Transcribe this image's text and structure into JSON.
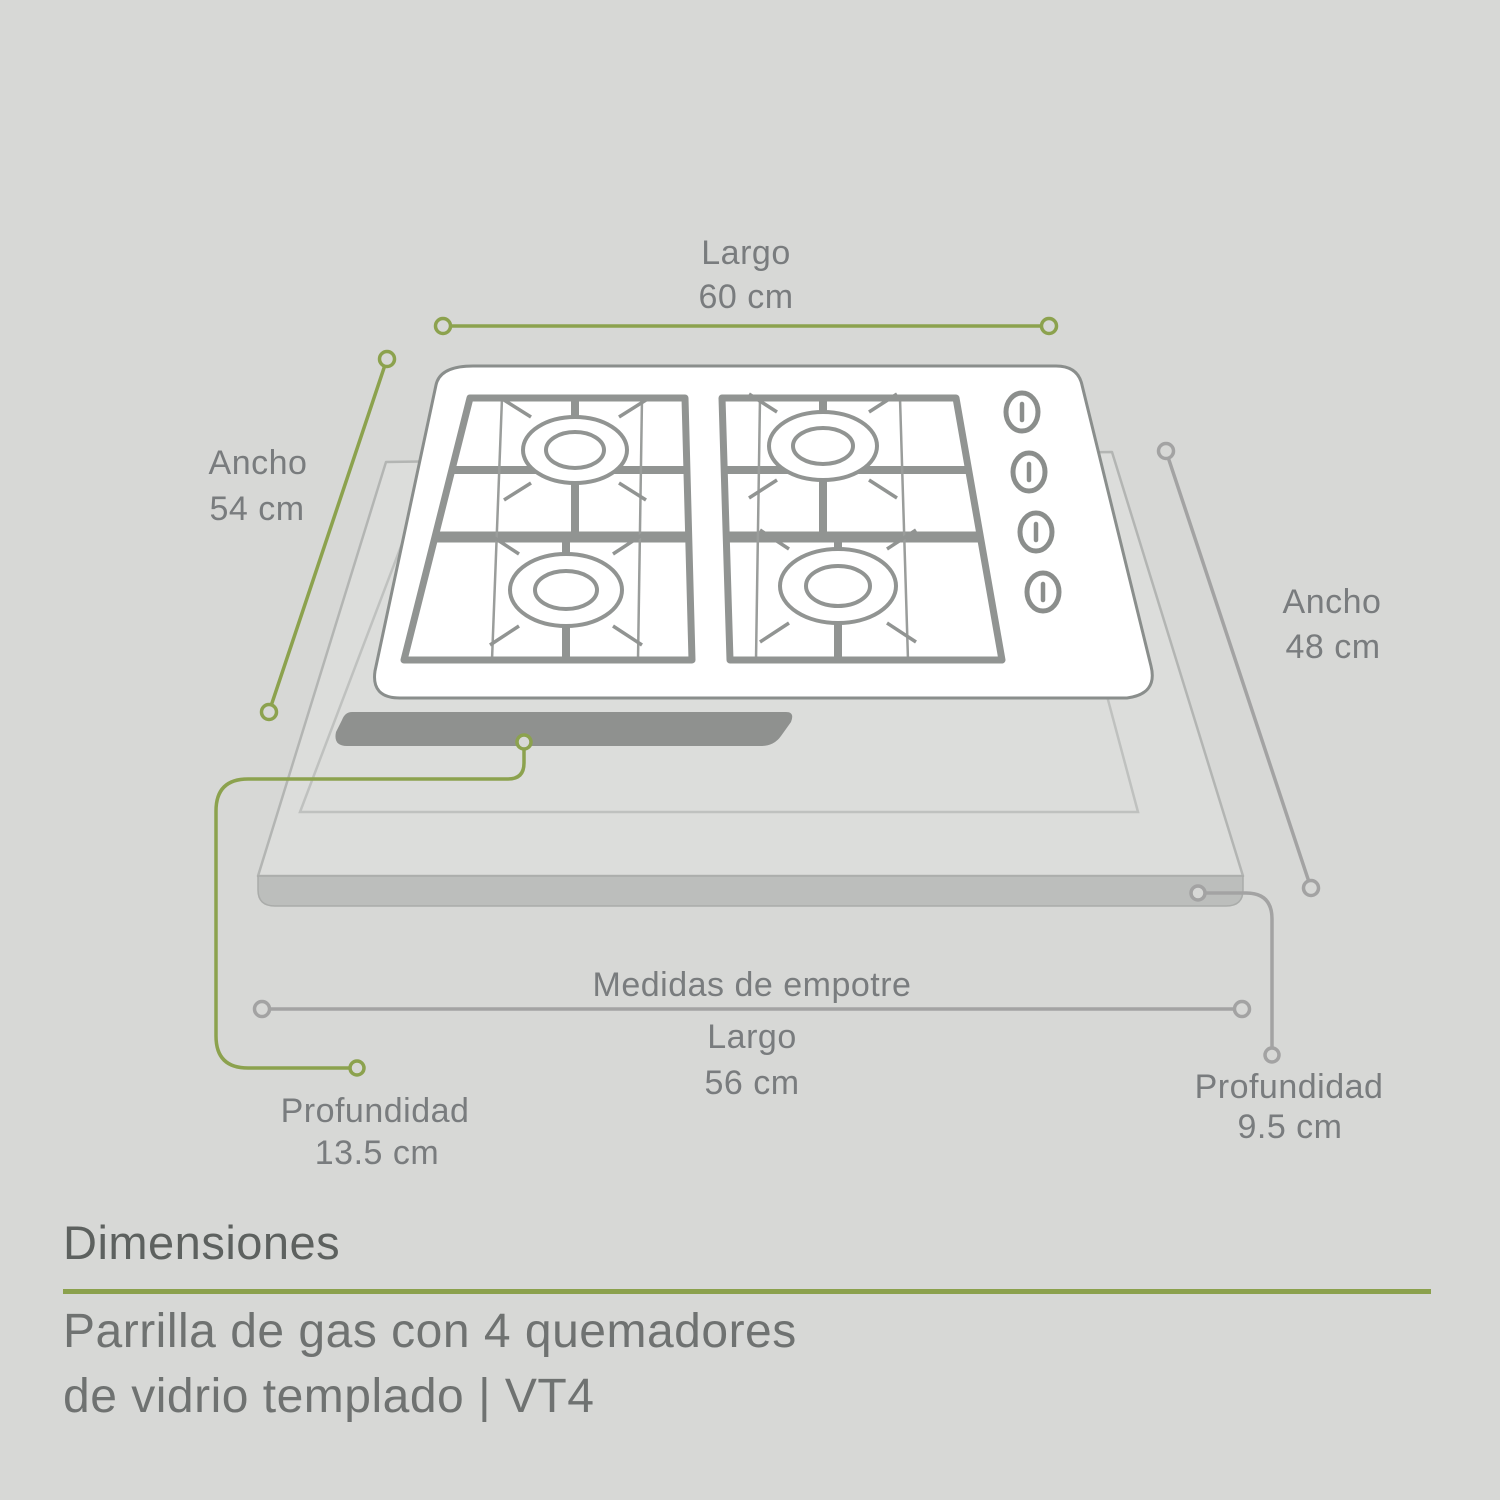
{
  "illustration": {
    "type": "gas-cooktop-dimensions-diagram",
    "burner_count": 4,
    "knob_count": 4,
    "dimensions": {
      "top_length": {
        "label": "Largo",
        "value": "60 cm"
      },
      "left_width": {
        "label": "Ancho",
        "value": "54 cm"
      },
      "right_width": {
        "label": "Ancho",
        "value": "48 cm"
      },
      "cutout": {
        "title": "Medidas de empotre",
        "label": "Largo",
        "value": "56 cm"
      },
      "depth_left": {
        "label": "Profundidad",
        "value": "13.5 cm"
      },
      "depth_right": {
        "label": "Profundidad",
        "value": "9.5 cm"
      }
    },
    "colors": {
      "background": "#d7d8d6",
      "accent_green": "#8ca24e",
      "dimension_gray": "#a3a3a3",
      "label_text": "#797c7e",
      "cooktop_outline": "#8a8e8c",
      "grate_gray": "#919492"
    }
  },
  "footer": {
    "section_title": "Dimensiones",
    "divider_color": "#8ba14d",
    "product_line1": "Parrilla de gas con 4 quemadores",
    "product_line2": "de vidrio templado | VT4"
  }
}
